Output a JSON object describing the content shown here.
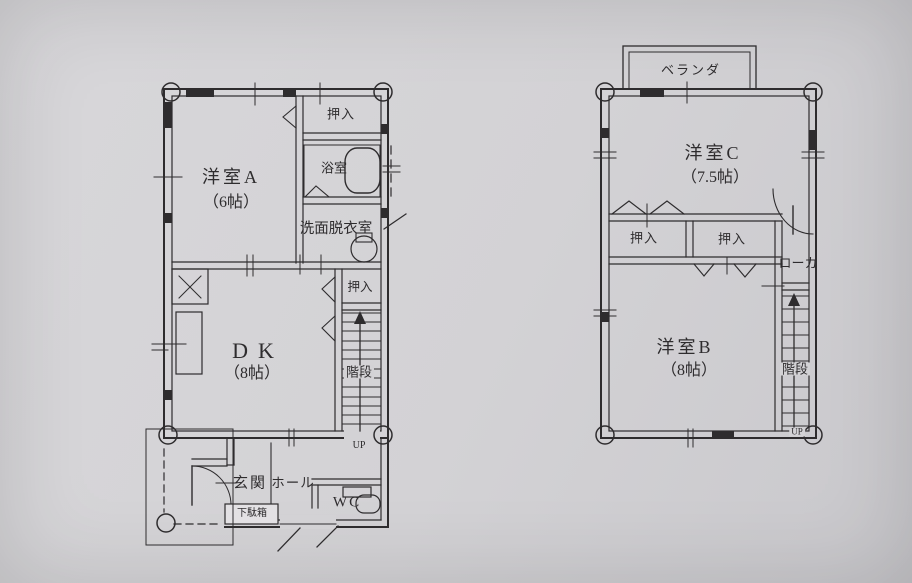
{
  "theme": {
    "paper": "#d3d2d5",
    "ink": "#2e2c2e"
  },
  "f1": {
    "room_a": {
      "name": "洋室A",
      "size": "（6帖）"
    },
    "closet_top": "押入",
    "bath": "浴室",
    "washroom": "洗面脱衣室",
    "dk": {
      "name": "DK",
      "size": "（8帖）"
    },
    "closet_dk": "押入",
    "stairs": "階段",
    "up": "UP",
    "genkan": "玄関",
    "hall": "ホール",
    "shoe_box": "下駄箱",
    "wc": "WC"
  },
  "f2": {
    "veranda": "ベランダ",
    "room_c": {
      "name": "洋室C",
      "size": "（7.5帖）"
    },
    "closet_left": "押入",
    "closet_right": "押入",
    "hallway": "ローカ",
    "room_b": {
      "name": "洋室B",
      "size": "（8帖）"
    },
    "stairs": "階段",
    "up": "UP"
  }
}
